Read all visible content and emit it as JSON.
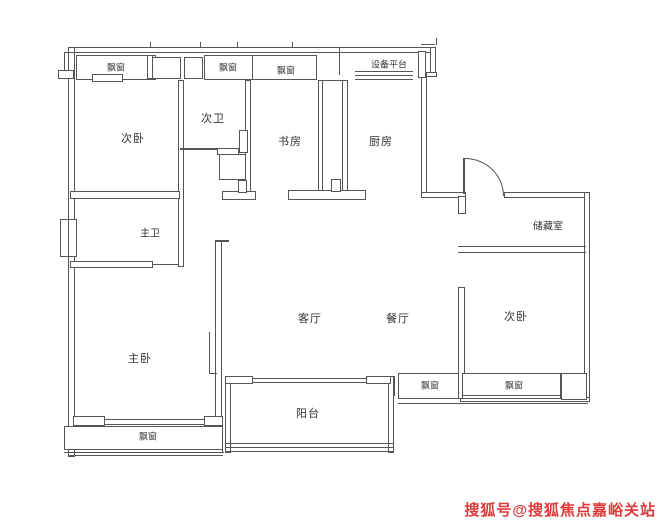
{
  "plan": {
    "rooms": {
      "bedroom_top_left": "次卧",
      "bath_second": "次卫",
      "study": "书房",
      "kitchen": "厨房",
      "equipment_platform": "设备平台",
      "storage": "储藏室",
      "bath_master": "主卫",
      "bedroom_master": "主卧",
      "living": "客厅",
      "dining": "餐厅",
      "bedroom_right": "次卧",
      "balcony": "阳台"
    },
    "bay_window": "飘窗"
  },
  "watermark": {
    "text": "搜狐号@搜狐焦点嘉峪关站",
    "color": "#dd3b3b"
  },
  "colors": {
    "wall_line": "#555555",
    "label_text": "#333333",
    "background": "#ffffff"
  }
}
